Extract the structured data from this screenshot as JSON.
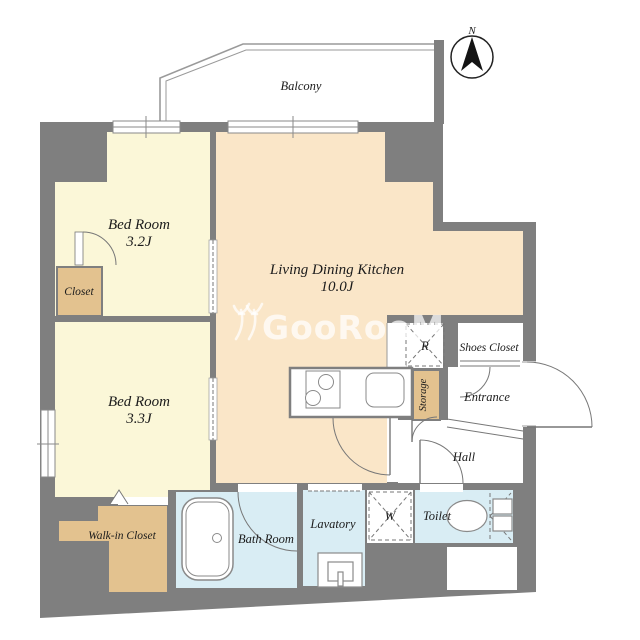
{
  "compass": {
    "north_label": "N"
  },
  "balcony": {
    "label": "Balcony"
  },
  "watermark": {
    "text": "GooRooM",
    "logo_icon": "fork-monogram"
  },
  "rooms": {
    "bedroom_1": {
      "label": "Bed Room",
      "size": "3.2J"
    },
    "bedroom_2": {
      "label": "Bed Room",
      "size": "3.3J"
    },
    "ldk": {
      "label": "Living Dining Kitchen",
      "size": "10.0J"
    },
    "closet": {
      "label": "Closet"
    },
    "walk_in_closet": {
      "label": "Walk-in Closet"
    },
    "bath_room": {
      "label": "Bath Room"
    },
    "lavatory": {
      "label": "Lavatory"
    },
    "toilet": {
      "label": "Toilet"
    },
    "storage": {
      "label": "Storage"
    },
    "entrance": {
      "label": "Entrance"
    },
    "shoes_closet": {
      "label": "Shoes Closet"
    },
    "hall": {
      "label": "Hall"
    }
  },
  "fixtures": {
    "refrigerator_marker": "R",
    "washing_machine_marker": "W"
  },
  "colors": {
    "wall": "#7f7f7f",
    "bedroom_floor": "#fbf7d8",
    "ldk_floor": "#fae6c8",
    "closet_floor": "#e3c28f",
    "wet_area_floor": "#d9edf4",
    "background": "#ffffff"
  }
}
